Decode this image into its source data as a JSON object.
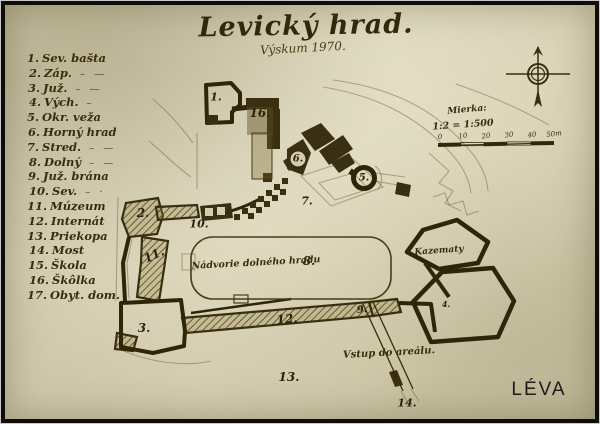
{
  "title": {
    "text": "Levický hrad.",
    "subtitle": "Výskum 1970."
  },
  "legend": {
    "items": [
      {
        "num": "1.",
        "label": "Sev. bašta",
        "ditto": ""
      },
      {
        "num": "2.",
        "label": "Záp.",
        "ditto": "– —"
      },
      {
        "num": "3.",
        "label": "Juž.",
        "ditto": "– —"
      },
      {
        "num": "4.",
        "label": "Vých.",
        "ditto": "–"
      },
      {
        "num": "5.",
        "label": "Okr. veža",
        "ditto": ""
      },
      {
        "num": "6.",
        "label": "Horný hrad",
        "ditto": ""
      },
      {
        "num": "7.",
        "label": "Stred.",
        "ditto": "– —"
      },
      {
        "num": "8.",
        "label": "Dolný",
        "ditto": "– —"
      },
      {
        "num": "9.",
        "label": "Juž. brána",
        "ditto": ""
      },
      {
        "num": "10.",
        "label": "Sev.",
        "ditto": "– ·"
      },
      {
        "num": "11.",
        "label": "Múzeum",
        "ditto": ""
      },
      {
        "num": "12.",
        "label": "Internát",
        "ditto": ""
      },
      {
        "num": "13.",
        "label": "Priekopa",
        "ditto": ""
      },
      {
        "num": "14.",
        "label": "Most",
        "ditto": ""
      },
      {
        "num": "15.",
        "label": "Škola",
        "ditto": ""
      },
      {
        "num": "16.",
        "label": "Škôlka",
        "ditto": ""
      },
      {
        "num": "17.",
        "label": "Obyt. dom.",
        "ditto": ""
      }
    ]
  },
  "scale": {
    "caption": "Mierka:",
    "ratio": "1:2 = 1:500",
    "ticks": [
      "0",
      "10",
      "20",
      "30",
      "40",
      "50m"
    ]
  },
  "map": {
    "labels": {
      "n1": "1.",
      "n2": "2.",
      "n3": "3.",
      "n4": "4.",
      "n5": "5.",
      "n6": "6.",
      "n7": "7.",
      "n8": "8.",
      "n9": "9.",
      "n10": "10.",
      "n11": "11.",
      "n12": "12.",
      "n13": "13.",
      "n14": "14.",
      "n16": "16.",
      "courtyard": "Nádvorie dolného hradu",
      "kazematy": "Kazematy",
      "entrance": "Vstup do areálu."
    }
  },
  "footer": {
    "city": "LÉVA"
  },
  "colors": {
    "paper": "#d6d0b3",
    "ink": "#33280d",
    "hatch": "#6b5a22"
  }
}
